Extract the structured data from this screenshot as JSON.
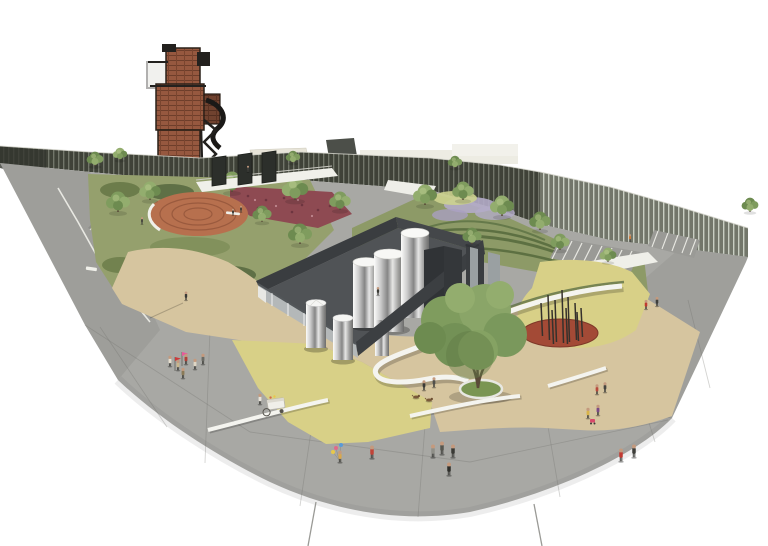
{
  "meta": {
    "subject": "aerial axonometric architectural rendering of a fan-shaped urban plaza with industrial tower, slatted perimeter wall, gardens, silo enclosure and scattered pedestrians"
  },
  "palette": {
    "bg": "#ffffff",
    "plaza": "#a8a8a4",
    "ramp": "#9b9b97",
    "wallDark": "#3f4238",
    "wallSlat": "#8e9486",
    "wallLightBase": "#75796d",
    "wallLightSlat": "#d8dcd0",
    "lawn": "#95a06d",
    "terrace": "#8d9a67",
    "shrub": "#5f7046",
    "bed": "#8e4a52",
    "terracotta": "#b7704e",
    "ring": "#9a5a3e",
    "tan": "#d6c59f",
    "yellow": "#d8d087",
    "loopWhite": "#f4f4ef",
    "floor": "#505356",
    "wallFaceDark": "#3c3f42",
    "wallFaceLight": "#b4b8b9",
    "panelGray": "#9aa0a2",
    "redOval": "#a34a36",
    "brick": "#96583f",
    "steel": "#23211e",
    "trunk": "#5a4a38",
    "treeGreens": [
      "#7f9c5e",
      "#93ad6e",
      "#6d8b50"
    ],
    "skin": "#c49a7e"
  },
  "scene": {
    "people": [
      {
        "x": 248,
        "y": 172,
        "c": "#3e3e3a",
        "s": 0.55
      },
      {
        "x": 142,
        "y": 224,
        "c": "#46463f",
        "s": 0.6
      },
      {
        "x": 233,
        "y": 215,
        "c": "#33332e",
        "s": 0.55
      },
      {
        "x": 241,
        "y": 212,
        "c": "#3c3c35",
        "s": 0.55
      },
      {
        "x": 378,
        "y": 295,
        "c": "#3a3a35",
        "s": 0.7
      },
      {
        "x": 630,
        "y": 241,
        "c": "#d07a35",
        "s": 0.6
      },
      {
        "x": 646,
        "y": 309,
        "c": "#c03a30",
        "s": 0.8
      },
      {
        "x": 657,
        "y": 306,
        "c": "#3f3f3b",
        "s": 0.8
      },
      {
        "x": 186,
        "y": 300,
        "c": "#3a3a36",
        "s": 0.75
      },
      {
        "x": 170,
        "y": 366,
        "c": "#e6dfcf",
        "s": 0.9
      },
      {
        "x": 178,
        "y": 370,
        "c": "#c7b68d",
        "s": 0.9
      },
      {
        "x": 186,
        "y": 364,
        "c": "#b04038",
        "s": 0.9
      },
      {
        "x": 195,
        "y": 369,
        "c": "#ded6c5",
        "s": 0.9
      },
      {
        "x": 203,
        "y": 364,
        "c": "#6a6a64",
        "s": 0.9
      },
      {
        "x": 183,
        "y": 378,
        "c": "#8a7a58",
        "s": 0.9
      },
      {
        "x": 260,
        "y": 404,
        "c": "#e8e4da",
        "s": 0.9
      },
      {
        "x": 424,
        "y": 390,
        "c": "#3a3a36",
        "s": 0.85
      },
      {
        "x": 434,
        "y": 387,
        "c": "#50504b",
        "s": 0.85
      },
      {
        "x": 597,
        "y": 394,
        "c": "#b84a3c",
        "s": 0.85
      },
      {
        "x": 605,
        "y": 392,
        "c": "#45453f",
        "s": 0.85
      },
      {
        "x": 588,
        "y": 418,
        "c": "#d8b44a",
        "s": 0.9
      },
      {
        "x": 598,
        "y": 415,
        "c": "#7a4a85",
        "s": 0.9
      },
      {
        "x": 340,
        "y": 462,
        "c": "#d8a84e",
        "s": 1.0
      },
      {
        "x": 372,
        "y": 458,
        "c": "#c04438",
        "s": 1.1
      },
      {
        "x": 433,
        "y": 457,
        "c": "#8f8f88",
        "s": 1.1
      },
      {
        "x": 442,
        "y": 454,
        "c": "#56564f",
        "s": 1.1
      },
      {
        "x": 453,
        "y": 457,
        "c": "#3a3a35",
        "s": 1.1
      },
      {
        "x": 449,
        "y": 475,
        "c": "#2f2f2b",
        "s": 1.1
      },
      {
        "x": 621,
        "y": 461,
        "c": "#c23a32",
        "s": 1.1
      },
      {
        "x": 634,
        "y": 457,
        "c": "#3d3d39",
        "s": 1.1
      }
    ],
    "trees": [
      {
        "x": 118,
        "y": 212,
        "s": 1.0,
        "c": 0
      },
      {
        "x": 150,
        "y": 200,
        "s": 0.9,
        "c": 1
      },
      {
        "x": 232,
        "y": 192,
        "s": 1.0,
        "c": 0
      },
      {
        "x": 295,
        "y": 200,
        "s": 1.1,
        "c": 1
      },
      {
        "x": 340,
        "y": 210,
        "s": 0.9,
        "c": 0
      },
      {
        "x": 262,
        "y": 222,
        "s": 0.8,
        "c": 2
      },
      {
        "x": 300,
        "y": 244,
        "s": 1.0,
        "c": 2
      },
      {
        "x": 425,
        "y": 205,
        "s": 1.0,
        "c": 1
      },
      {
        "x": 463,
        "y": 200,
        "s": 0.9,
        "c": 0
      },
      {
        "x": 502,
        "y": 216,
        "s": 1.0,
        "c": 1
      },
      {
        "x": 540,
        "y": 230,
        "s": 0.9,
        "c": 2
      },
      {
        "x": 472,
        "y": 244,
        "s": 0.8,
        "c": 2
      },
      {
        "x": 560,
        "y": 250,
        "s": 0.8,
        "c": 0
      },
      {
        "x": 608,
        "y": 262,
        "s": 0.7,
        "c": 1
      },
      {
        "x": 95,
        "y": 166,
        "s": 0.7,
        "c": 2
      },
      {
        "x": 120,
        "y": 160,
        "s": 0.6,
        "c": 1
      },
      {
        "x": 293,
        "y": 163,
        "s": 0.6,
        "c": 2
      },
      {
        "x": 455,
        "y": 168,
        "s": 0.6,
        "c": 2
      },
      {
        "x": 750,
        "y": 212,
        "s": 0.7,
        "c": 2
      }
    ],
    "poles": [
      {
        "x": 541,
        "y1": 303,
        "y2": 336
      },
      {
        "x": 548,
        "y1": 295,
        "y2": 340
      },
      {
        "x": 555,
        "y1": 300,
        "y2": 342
      },
      {
        "x": 562,
        "y1": 290,
        "y2": 343
      },
      {
        "x": 568,
        "y1": 297,
        "y2": 342
      },
      {
        "x": 575,
        "y1": 303,
        "y2": 340
      },
      {
        "x": 581,
        "y1": 308,
        "y2": 337
      },
      {
        "x": 552,
        "y1": 310,
        "y2": 344
      },
      {
        "x": 566,
        "y1": 308,
        "y2": 344
      },
      {
        "x": 577,
        "y1": 312,
        "y2": 341
      }
    ],
    "seams": [
      [
        85,
        325,
        250,
        432
      ],
      [
        250,
        432,
        470,
        462
      ],
      [
        470,
        462,
        668,
        420
      ],
      [
        322,
        357,
        300,
        506
      ],
      [
        430,
        360,
        418,
        517
      ],
      [
        540,
        380,
        560,
        497
      ],
      [
        210,
        330,
        205,
        463
      ],
      [
        620,
        330,
        655,
        442
      ],
      [
        688,
        300,
        710,
        388
      ],
      [
        322,
        357,
        672,
        418
      ],
      [
        100,
        327,
        167,
        427
      ]
    ],
    "flags": [
      {
        "x": 182,
        "y": 352,
        "c": "#e8589a"
      },
      {
        "x": 175,
        "y": 357,
        "c": "#cc3a3a"
      }
    ],
    "balloons": [
      {
        "x": 336,
        "y": 448,
        "c": "#e06a8a"
      },
      {
        "x": 341,
        "y": 445,
        "c": "#5a9ad8"
      },
      {
        "x": 333,
        "y": 452,
        "c": "#e8c84a"
      }
    ],
    "dogs": [
      {
        "x": 416,
        "y": 397
      },
      {
        "x": 429,
        "y": 400
      }
    ]
  }
}
